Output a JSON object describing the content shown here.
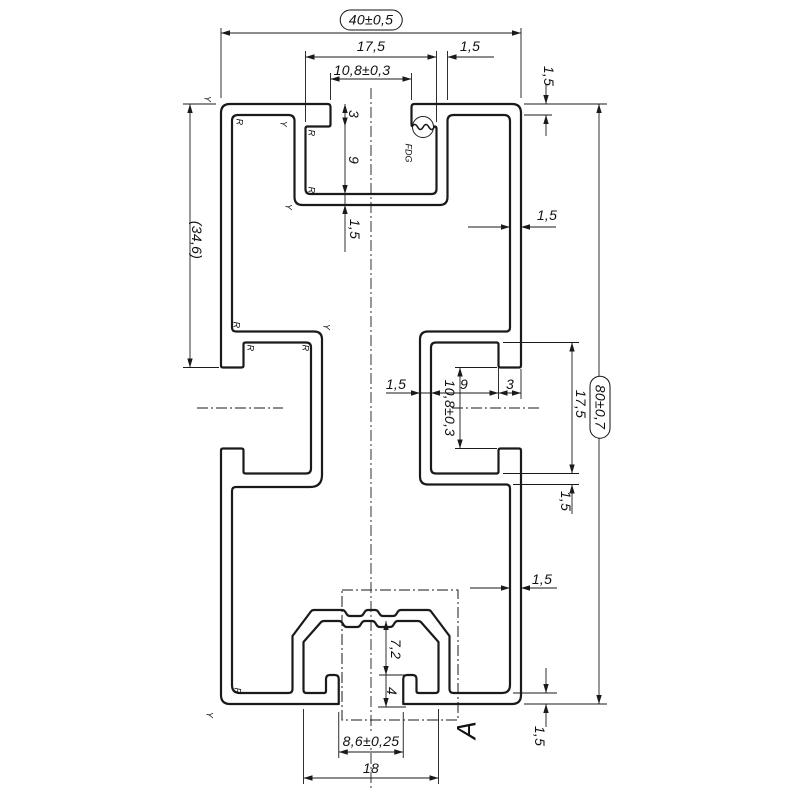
{
  "drawing": {
    "type_note": "extrusion profile cross-section drawing",
    "line_color": "#1a1a1a",
    "background": "#ffffff"
  },
  "dims": {
    "overall_width": "40±0,5",
    "overall_height": "80±0,7",
    "top_cavity_width": "17,5",
    "top_opening_width": "10,8±0,3",
    "top_cavity_wall": "1,5",
    "top_wall": "1,5",
    "left_height_ref": "(34,6)",
    "top_neck_depth": "3",
    "top_cavity_depth": "9",
    "top_floor": "1,5",
    "right_wall": "1,5",
    "right_wall_lower": "1,5",
    "side_slot_wall": "1,5",
    "side_cavity_depth": "9",
    "side_neck_depth": "3",
    "side_opening_height": "10,8±0,3",
    "side_cavity_height": "17,5",
    "side_under_wall": "1,5",
    "channel_inner_height": "7,2",
    "lip_height": "4",
    "mouth_width": "8,6±0,25",
    "channel_width": "18",
    "bottom_wall": "1,5"
  },
  "annotations": {
    "detail_label": "A",
    "functional_surface": "FDG",
    "radius_mark": "R",
    "y_mark": "Y"
  }
}
